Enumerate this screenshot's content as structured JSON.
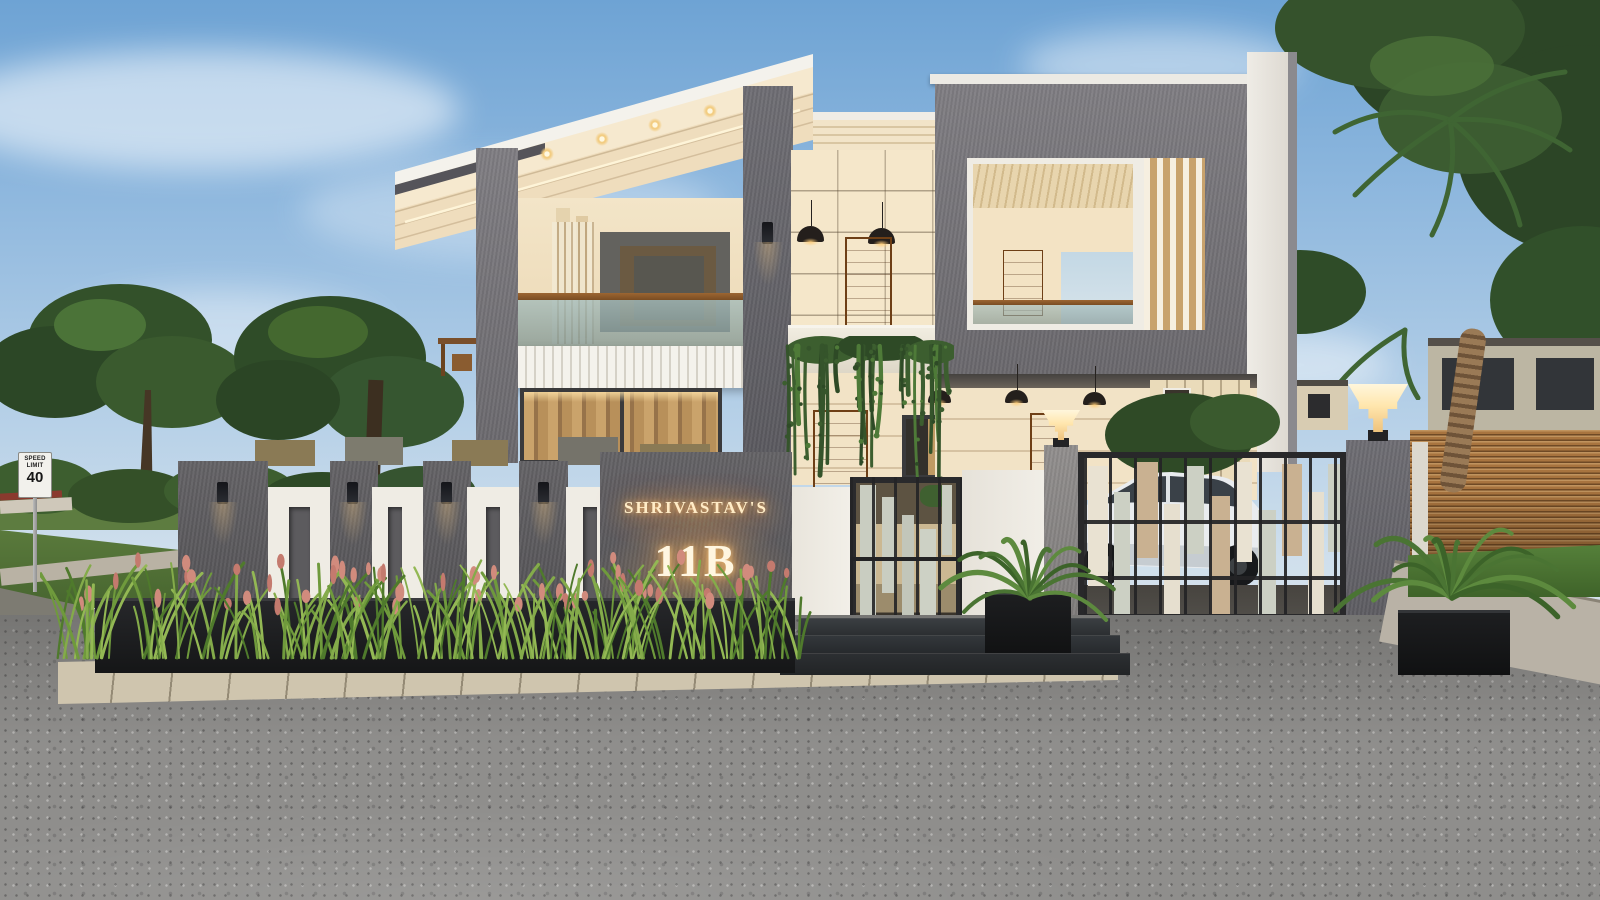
{
  "scene": {
    "type": "architectural-3d-exterior-render",
    "description": "Modern two-storey duplex house at dusk with illuminated name wall, designer compound wall, metal gates, white car in driveway, landscaped planters and street foreground",
    "house": {
      "nameplate": {
        "owner": "SHRIVASTAV'S",
        "number": "11B"
      }
    },
    "street": {
      "speed_sign": {
        "line1": "SPEED",
        "line2": "LIMIT",
        "value": "40"
      }
    },
    "palette": {
      "sky_top": "#7fadd8",
      "wall_cream": "#f2e3c6",
      "concrete_gray": "#6e6d72",
      "trim_white": "#efece4",
      "wood_door": "#b06a2a",
      "wood_fence": "#b5834c",
      "gate_metal": "#2a2a2c",
      "gate_panel_sage": "#c9cdc1",
      "gate_panel_tan": "#c9b191",
      "glow_warm": "#ffd9a0",
      "foliage_green": "#3f5b2f",
      "road_asphalt": "#8f8e8c",
      "car_white": "#e9ecef"
    }
  }
}
